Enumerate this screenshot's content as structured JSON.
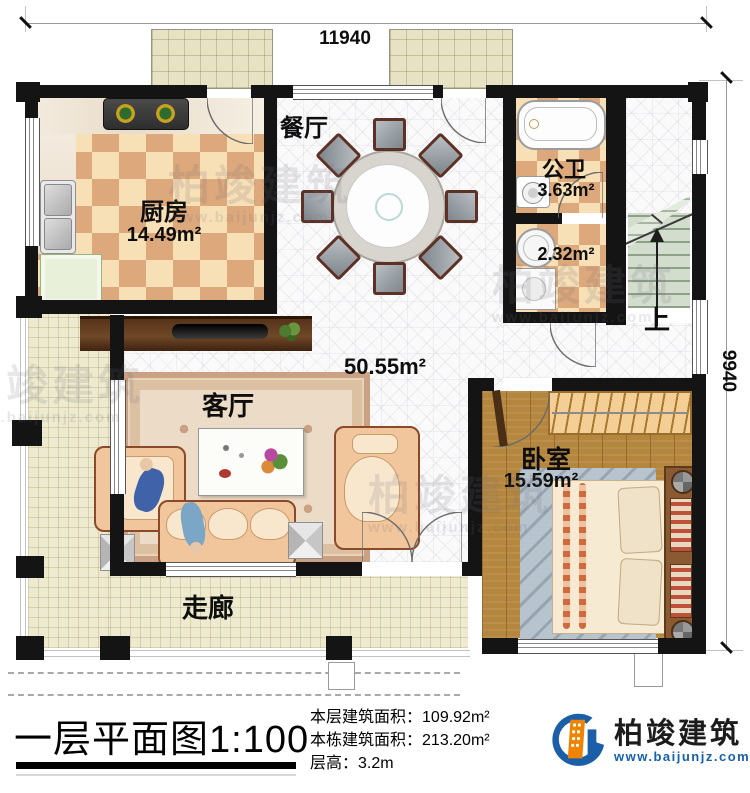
{
  "dims": {
    "width_label": "11940",
    "height_label": "9940"
  },
  "rooms": {
    "dining": {
      "name": "餐厅"
    },
    "kitchen": {
      "name": "厨房",
      "area": "14.49m²"
    },
    "bath": {
      "name": "公卫",
      "area": "3.63m²"
    },
    "utility": {
      "area": "2.32m²"
    },
    "hall": {
      "area": "50.55m²"
    },
    "living": {
      "name": "客厅"
    },
    "bedroom": {
      "name": "卧室",
      "area": "15.59m²"
    },
    "corridor": {
      "name": "走廊"
    },
    "stairs": {
      "up_label": "上"
    }
  },
  "titlebar": {
    "title": "一层平面图",
    "scale": "1:100",
    "stats": [
      {
        "label": "本层建筑面积：",
        "value": "109.92m²"
      },
      {
        "label": "本栋建筑面积：",
        "value": "213.20m²"
      },
      {
        "label": "层高：",
        "value": "3.2m"
      }
    ],
    "logo": {
      "name": "柏竣建筑",
      "url": "www.baijunjz.com"
    }
  },
  "watermark": {
    "name": "柏竣建筑",
    "url": "www.baijunjz.com"
  },
  "colors": {
    "accent_blue": "#1a5fa8",
    "accent_orange": "#f08300",
    "wall": "#141414"
  }
}
